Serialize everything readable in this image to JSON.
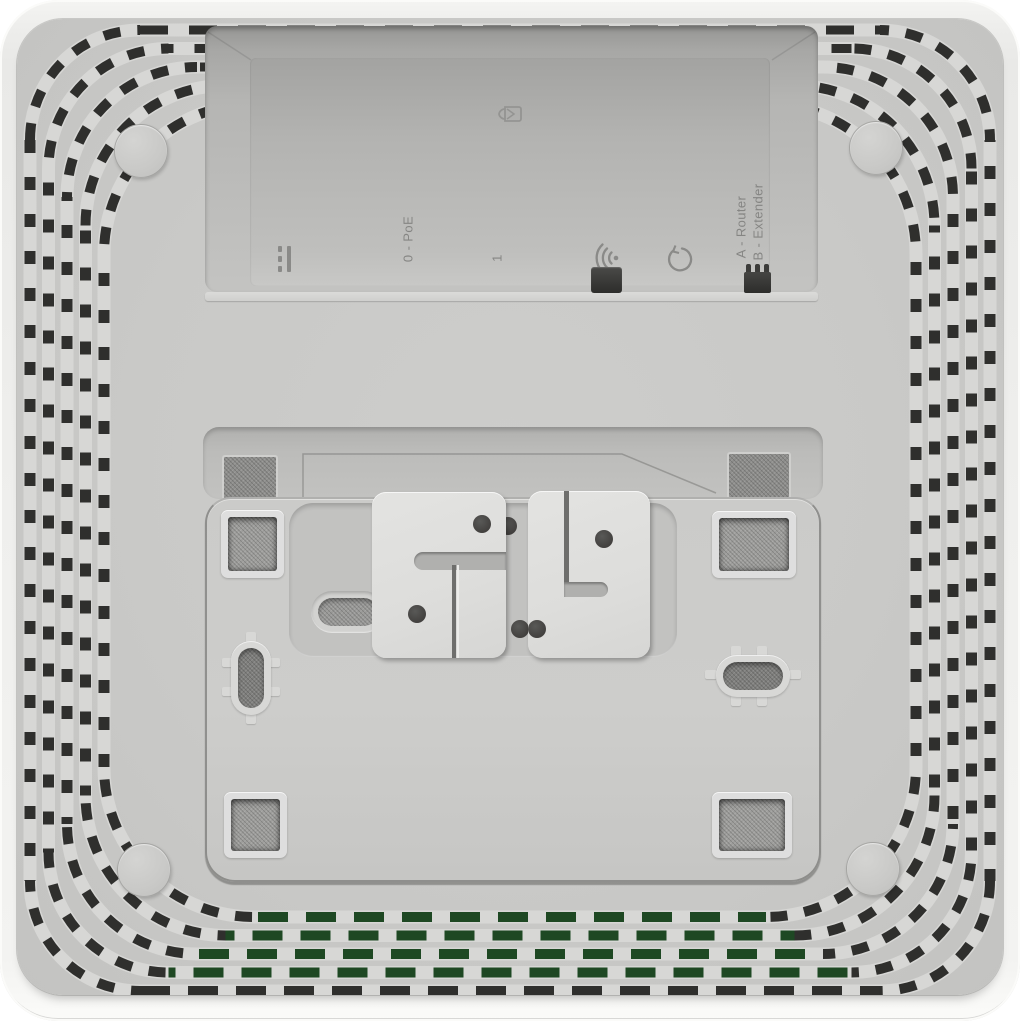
{
  "device": {
    "connector_bay": {
      "labels": {
        "poe_port": "0 - PoE",
        "lan_port": "1",
        "mode_router": "A - Router",
        "mode_extender": "B - Extender"
      },
      "icons": {
        "power": "dc-power-icon",
        "security": "lock-icon",
        "wps": "wifi-icon",
        "reset": "reset-icon"
      }
    },
    "colors": {
      "shell": "#f0f0ee",
      "panel": "#c8c8c6",
      "vent_track": "#d7d7d5",
      "vent_dark": "#2f2f2d",
      "vent_green": "#1e4823",
      "engraving": "#8a8a88",
      "plate": "#cacac8",
      "bracket": "#e0e0de"
    }
  }
}
